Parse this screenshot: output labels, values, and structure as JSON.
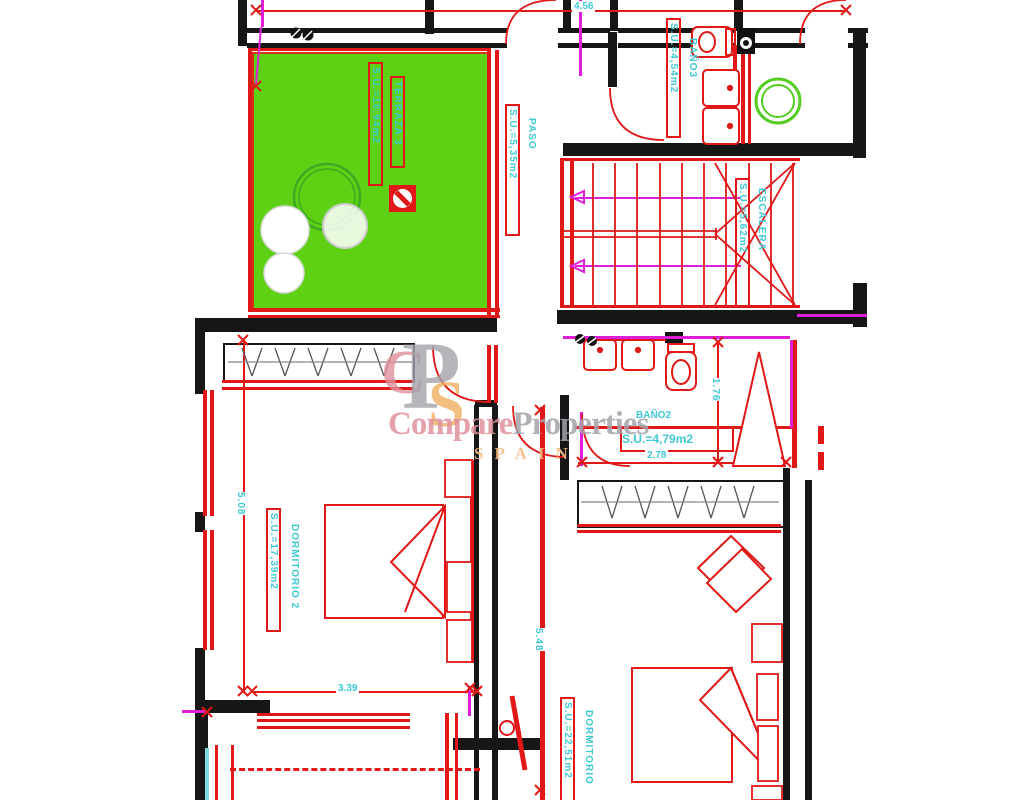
{
  "rooms": {
    "terraza": {
      "name": "TERRAZA 3",
      "area": "S.U.=10,94m2"
    },
    "paso": {
      "name": "PASO",
      "area": "S.U.=5,35m2"
    },
    "bano3": {
      "name": "BAÑO3",
      "area": "S.U.=4,54m2"
    },
    "escalera": {
      "name": "ESCALERA",
      "area": "S.U.=5,62m2"
    },
    "bano2": {
      "name": "BAÑO2",
      "area": "S.U.=4,79m2"
    },
    "dormitorio2": {
      "name": "DORMITORIO 2",
      "area": "S.U.=17,39m2"
    },
    "dormitorio": {
      "name": "DORMITORIO",
      "area": "S.U.=22,51m2"
    }
  },
  "dimensions": {
    "top": "4.56",
    "left": "5.08",
    "bottom": "3.39",
    "corridor": "5.48",
    "bano2_v": "1.76",
    "bano2_h": "2.78"
  },
  "watermark": {
    "compare": "Compare",
    "properties": "Properties",
    "spain": "SPAIN",
    "mono_c": "C",
    "mono_p": "P",
    "mono_s": "S"
  },
  "symbols": {
    "vent_pair": "⌀⌀"
  },
  "colors": {
    "wall_black": "#161616",
    "cad_red": "#e01818",
    "label_cyan": "#3fc9d4",
    "magenta": "#e020d8",
    "terrace_green": "#5ed115",
    "washer_green": "#55cc22",
    "watermark_pink": "#e0919d",
    "watermark_gray": "#a3a3ab",
    "watermark_orange": "#f5bd85"
  }
}
